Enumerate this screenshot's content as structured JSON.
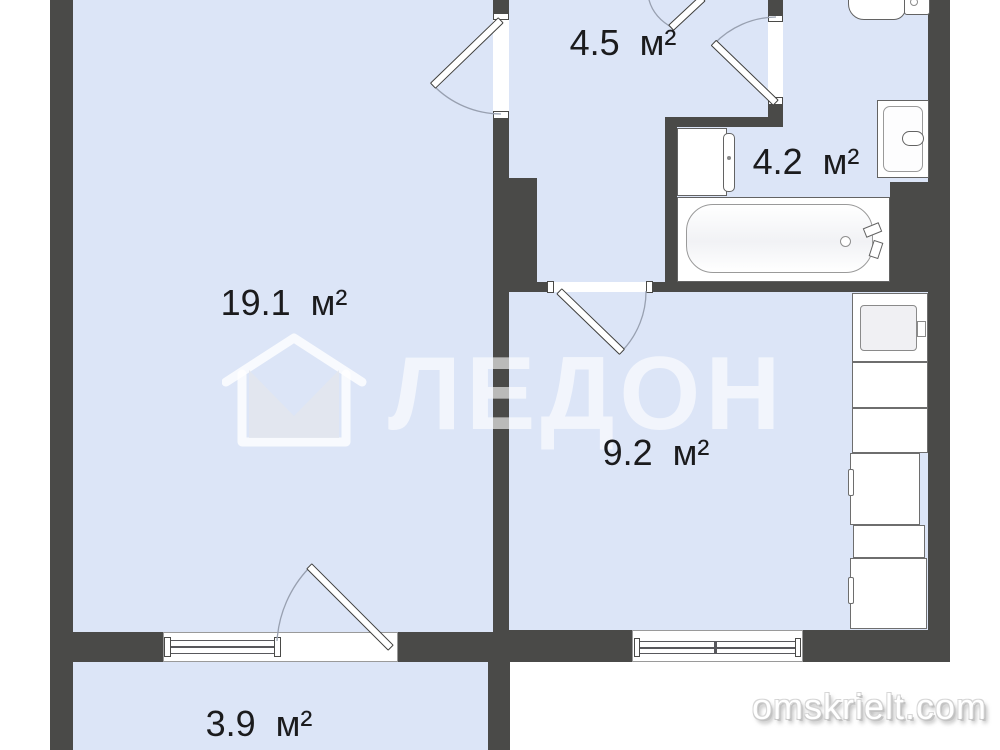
{
  "rooms": [
    {
      "id": "living-room",
      "area_label": "19.1  м²"
    },
    {
      "id": "hallway",
      "area_label": "4.5  м²"
    },
    {
      "id": "bathroom",
      "area_label": "4.2  м²"
    },
    {
      "id": "kitchen",
      "area_label": "9.2  м²"
    },
    {
      "id": "balcony",
      "area_label": "3.9  м²"
    }
  ],
  "watermarks": {
    "agency_name": "ЛЕДОН",
    "agency_logo_icon": "house-envelope-icon",
    "site": "omskrielt.com"
  },
  "colors": {
    "wall": "#4a4a48",
    "floor_fill": "#dce5f7",
    "fixture_outline": "#636363",
    "door_arc": "#98a0b0",
    "label_text": "#1b1b1d"
  },
  "fixtures": [
    "toilet",
    "bathroom-sink",
    "washing-machine",
    "bathtub",
    "kitchen-sink-unit",
    "kitchen-cabinets",
    "fridge",
    "living-room-window",
    "kitchen-window",
    "balcony-door",
    "entrance-door",
    "interior-doors"
  ]
}
